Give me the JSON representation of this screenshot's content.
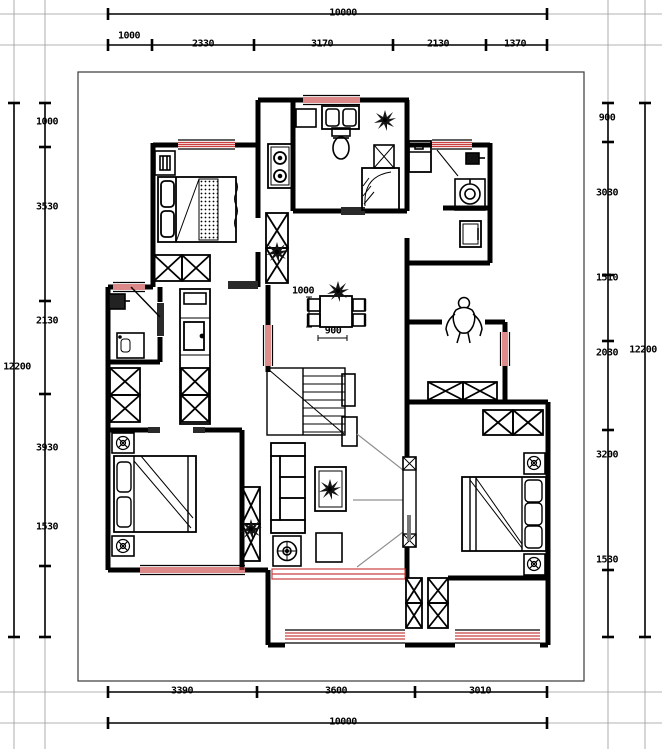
{
  "drawing": {
    "kind": "residential floor plan",
    "units": "mm",
    "colors": {
      "wall": "#000000",
      "window": "#c84040",
      "door_swing": "#909090",
      "dimension": "#000000",
      "frame": "#999999"
    }
  },
  "dims": {
    "top": {
      "total": "10000",
      "chain": [
        "1000",
        "2330",
        "3170",
        "2130",
        "1370"
      ]
    },
    "bottom": {
      "total": "10000",
      "chain": [
        "3390",
        "3600",
        "3010"
      ]
    },
    "left": {
      "total": "12200",
      "chain": [
        "1000",
        "3530",
        "2130",
        "3930",
        "1530"
      ]
    },
    "right": {
      "total": "12200",
      "chain": [
        "900",
        "3030",
        "1510",
        "2030",
        "3200",
        "1530"
      ]
    },
    "interior": {
      "width": "1000",
      "depth": "900"
    }
  }
}
